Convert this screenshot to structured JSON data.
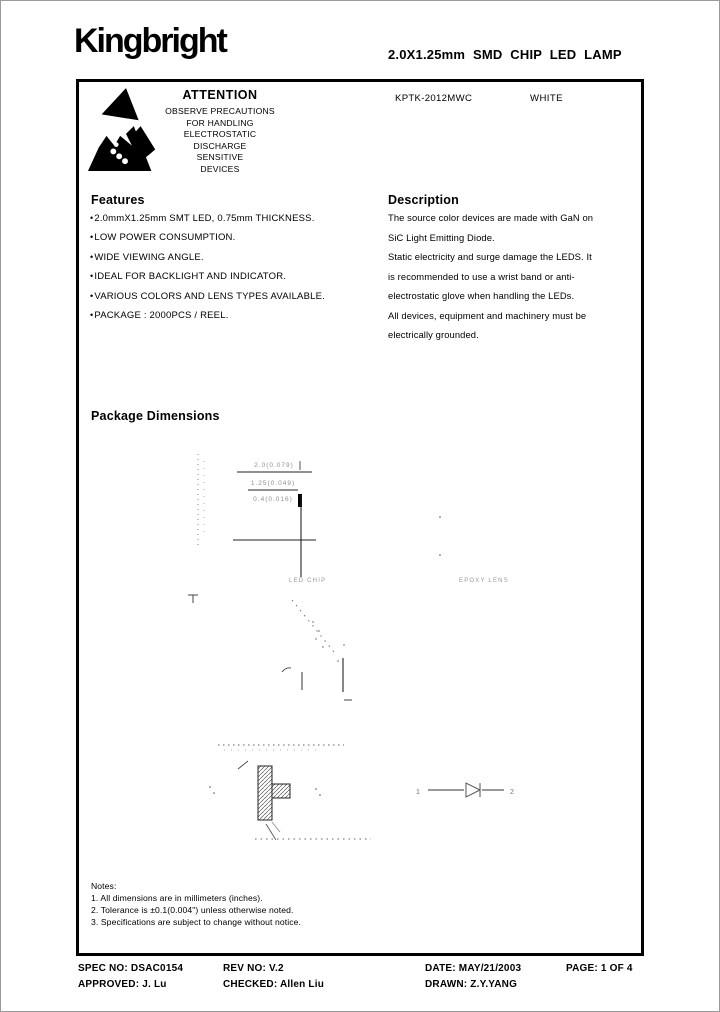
{
  "header": {
    "logo": "Kingbright",
    "title": "2.0X1.25mm SMD CHIP LED LAMP"
  },
  "attention": {
    "heading": "ATTENTION",
    "lines": [
      "OBSERVE PRECAUTIONS",
      "FOR HANDLING",
      "ELECTROSTATIC",
      "DISCHARGE",
      "SENSITIVE",
      "DEVICES"
    ],
    "part_number": "KPTK-2012MWC",
    "color_name": "WHITE"
  },
  "features": {
    "heading": "Features",
    "items": [
      "2.0mmX1.25mm SMT LED, 0.75mm THICKNESS.",
      "LOW POWER CONSUMPTION.",
      "WIDE VIEWING ANGLE.",
      "IDEAL FOR BACKLIGHT AND INDICATOR.",
      "VARIOUS COLORS AND LENS TYPES AVAILABLE.",
      "PACKAGE : 2000PCS / REEL."
    ]
  },
  "description": {
    "heading": "Description",
    "lines": [
      "The  source color devices are made with GaN on",
      "SiC Light Emitting Diode.",
      "Static electricity and surge damage the LEDS. It",
      "is recommended to use a wrist band or anti-",
      "electrostatic glove when handling the LEDs.",
      "All devices, equipment and machinery  must be",
      "electrically  grounded."
    ]
  },
  "package_dimensions": {
    "heading": "Package Dimensions",
    "drawing": {
      "dim_top": "2.0(0.079)",
      "dim_mid": "1.25(0.049)",
      "dim_low": "0.4(0.016)",
      "label_led": "LED CHIP",
      "label_epoxy": "EPOXY LENS",
      "polarity_pin1": "1",
      "polarity_pin2": "2"
    }
  },
  "notes": {
    "heading": "Notes:",
    "items": [
      "1. All dimensions are in millimeters (inches).",
      "2. Tolerance is ±0.1(0.004\") unless otherwise noted.",
      "3. Specifications are subject to change without notice."
    ]
  },
  "footer": {
    "spec_no": "SPEC NO: DSAC0154",
    "rev_no": "REV NO: V.2",
    "date": "DATE: MAY/21/2003",
    "page": "PAGE:  1 OF 4",
    "approved": "APPROVED: J. Lu",
    "checked": "CHECKED: Allen Liu",
    "drawn": "DRAWN: Z.Y.YANG"
  },
  "colors": {
    "ink": "#000000",
    "faint": "#8f8f8f",
    "paper": "#ffffff"
  }
}
